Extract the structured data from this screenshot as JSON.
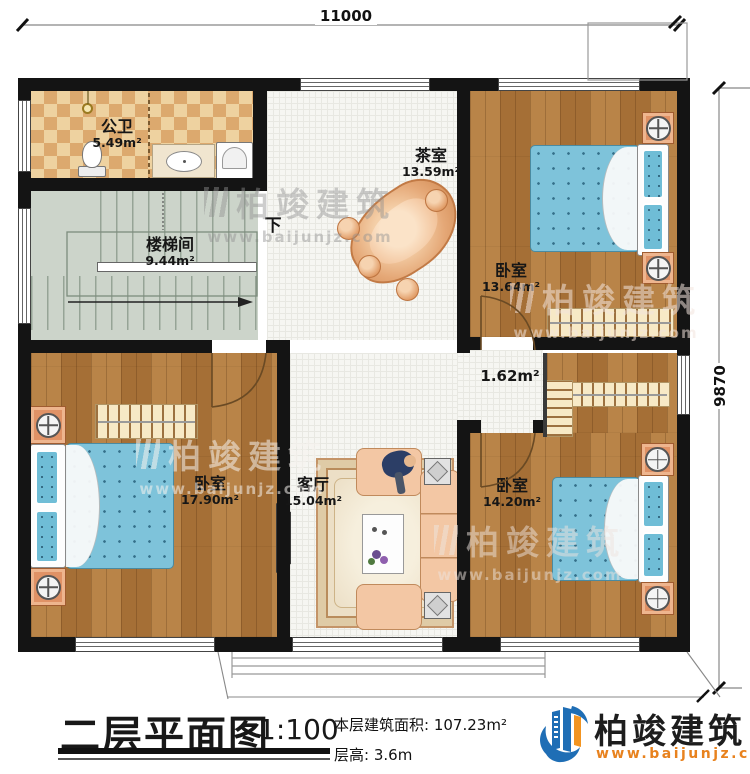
{
  "plan": {
    "dim_top": "11000",
    "dim_right": "9870",
    "down_label": "下",
    "rooms": {
      "bathroom": {
        "name": "公卫",
        "area": "5.49m²"
      },
      "stair": {
        "name": "楼梯间",
        "area": "9.44m²"
      },
      "tea": {
        "name": "茶室",
        "area": "13.59m²"
      },
      "bed_tr": {
        "name": "卧室",
        "area": "13.64m²"
      },
      "nook": {
        "area": "1.62m²"
      },
      "bed_bl": {
        "name": "卧室",
        "area": "17.90m²"
      },
      "living": {
        "name": "客厅",
        "area": "15.04m²"
      },
      "bed_br": {
        "name": "卧室",
        "area": "14.20m²"
      }
    }
  },
  "title_block": {
    "title": "二层平面图",
    "scale": "1:100",
    "area_label": "本层建筑面积:",
    "area_value": "107.23m²",
    "floor_height_label": "层高:",
    "floor_height_value": "3.6m"
  },
  "brand": {
    "name": "柏竣建筑",
    "website": "www.baijunjz.com"
  },
  "watermark": {
    "text": "柏竣建筑",
    "website": "www.baijunjz.com"
  },
  "colors": {
    "wall": "#141414",
    "wood_floor": "#b1793c",
    "tile_floor": "#f6f6f2",
    "checker_tile": "#dca96e",
    "stair_floor": "#ccd4ca",
    "bed_blue": "#7ec3da",
    "brand_blue": "#1f6eb5",
    "brand_orange": "#e8821e"
  }
}
